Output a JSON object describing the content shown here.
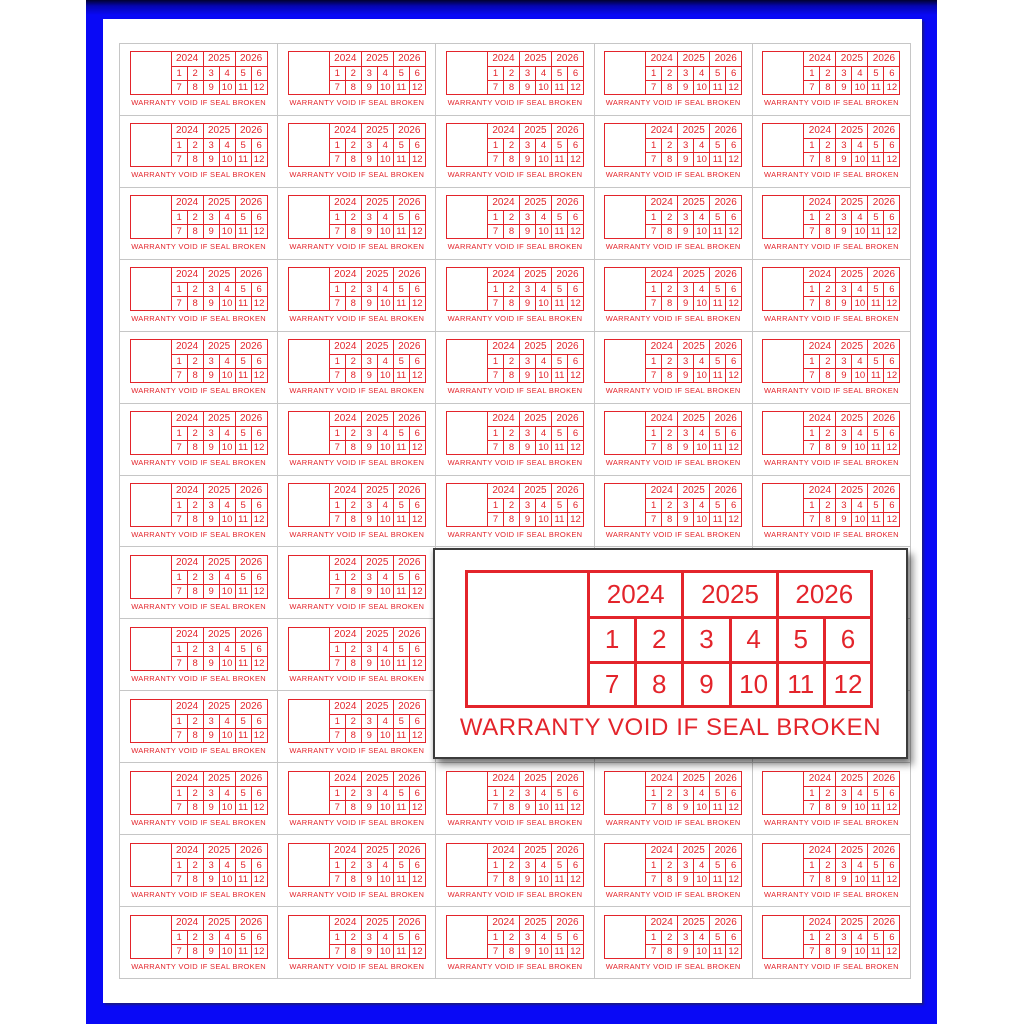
{
  "colors": {
    "sticker_red": "#e3242b",
    "frame_blue": "#0909f6",
    "grid_line": "#c6c6c6",
    "sheet_white": "#ffffff"
  },
  "sheet": {
    "rows": 13,
    "columns": 5
  },
  "sticker": {
    "years": [
      "2024",
      "2025",
      "2026"
    ],
    "months_row1": [
      "1",
      "2",
      "3",
      "4",
      "5",
      "6"
    ],
    "months_row2": [
      "7",
      "8",
      "9",
      "10",
      "11",
      "12"
    ],
    "warranty_text": "WARRANTY VOID IF SEAL BROKEN"
  }
}
